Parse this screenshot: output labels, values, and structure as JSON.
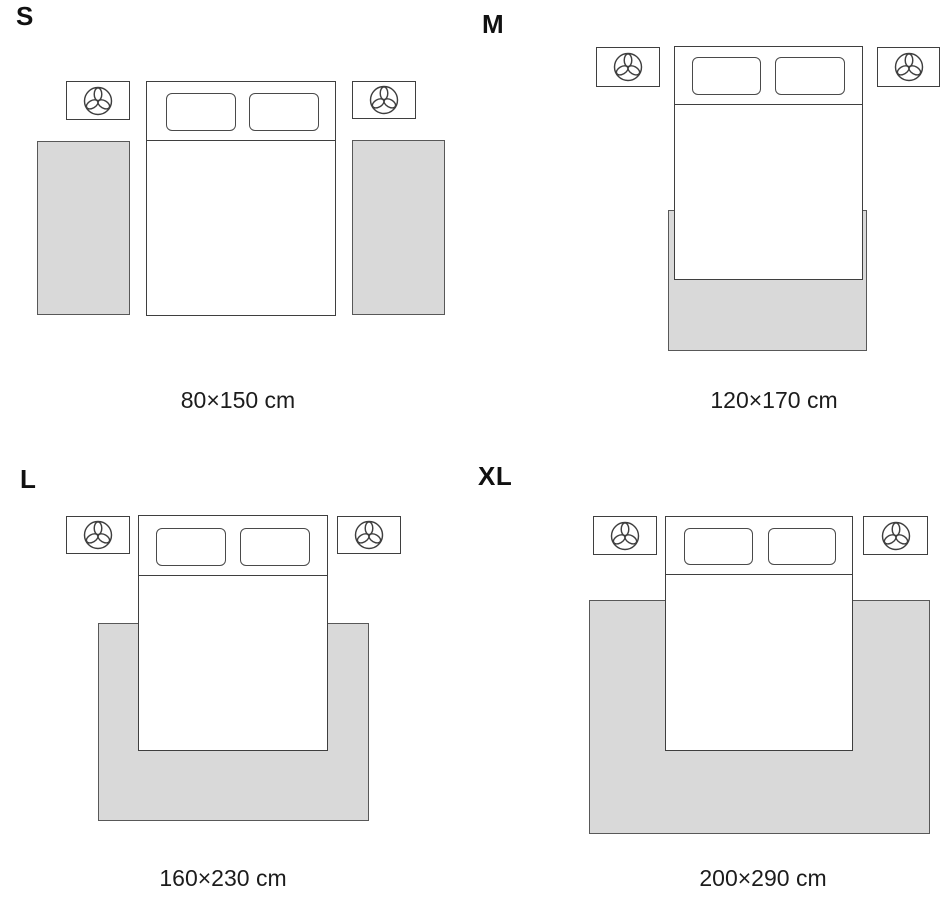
{
  "page": {
    "background": "#ffffff"
  },
  "colors": {
    "rug_fill": "#d9d9d9",
    "furniture_outline": "#3f3f3f",
    "rug_outline": "#585858",
    "text": "#1c1c1c"
  },
  "icons": {
    "nightstand_icon": "plant-icon"
  },
  "sizes": [
    {
      "label": "S",
      "dimensions": "80×150 cm"
    },
    {
      "label": "M",
      "dimensions": "120×170 cm"
    },
    {
      "label": "L",
      "dimensions": "160×230 cm"
    },
    {
      "label": "XL",
      "dimensions": "200×290 cm"
    }
  ]
}
